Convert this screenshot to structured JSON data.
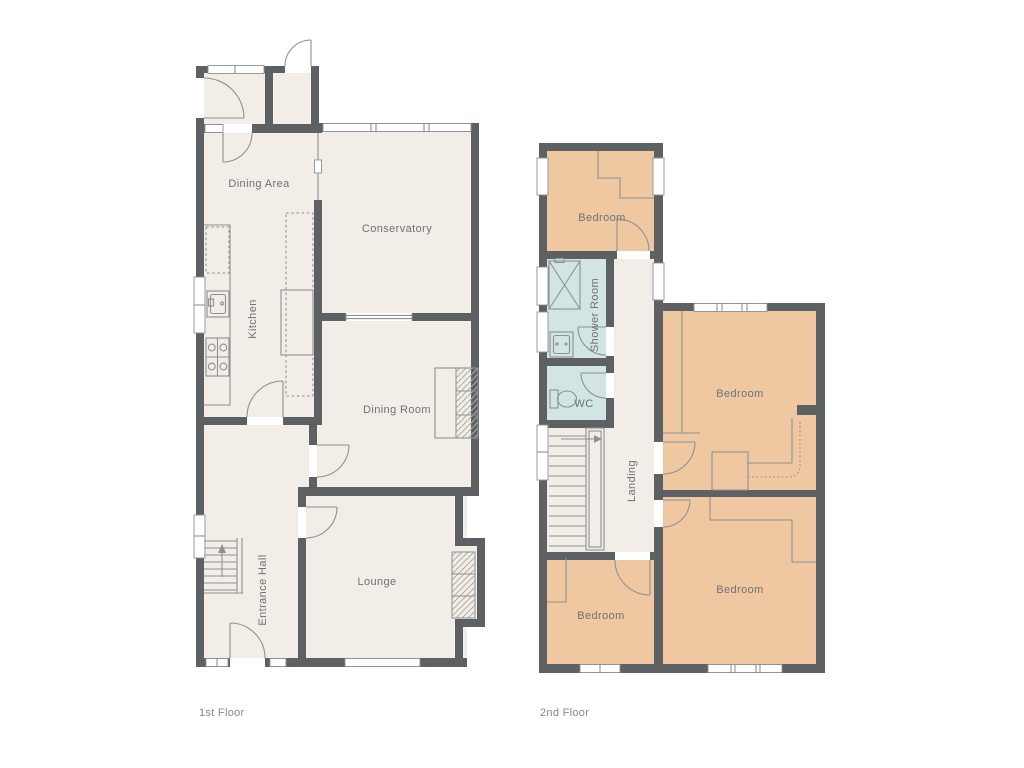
{
  "colors": {
    "background": "#ffffff",
    "wall": "#5d6164",
    "floor": "#f2ede6",
    "bedroom": "#efc8a2",
    "wet": "#d2e4e4",
    "line": "#8e9193",
    "hatch": "#aeaca7",
    "label": "#6e7276",
    "caption": "#85888b"
  },
  "floor1": {
    "caption": "1st Floor",
    "rooms": {
      "diningArea": "Dining Area",
      "conservatory": "Conservatory",
      "kitchen": "Kitchen",
      "diningRoom": "Dining Room",
      "entranceHall": "Entrance Hall",
      "lounge": "Lounge"
    }
  },
  "floor2": {
    "caption": "2nd Floor",
    "rooms": {
      "bedroomTop": "Bedroom",
      "showerRoom": "Shower Room",
      "wc": "WC",
      "landing": "Landing",
      "bedroomMiddle": "Bedroom",
      "bedroomBottomLeft": "Bedroom",
      "bedroomBottomRight": "Bedroom"
    }
  }
}
